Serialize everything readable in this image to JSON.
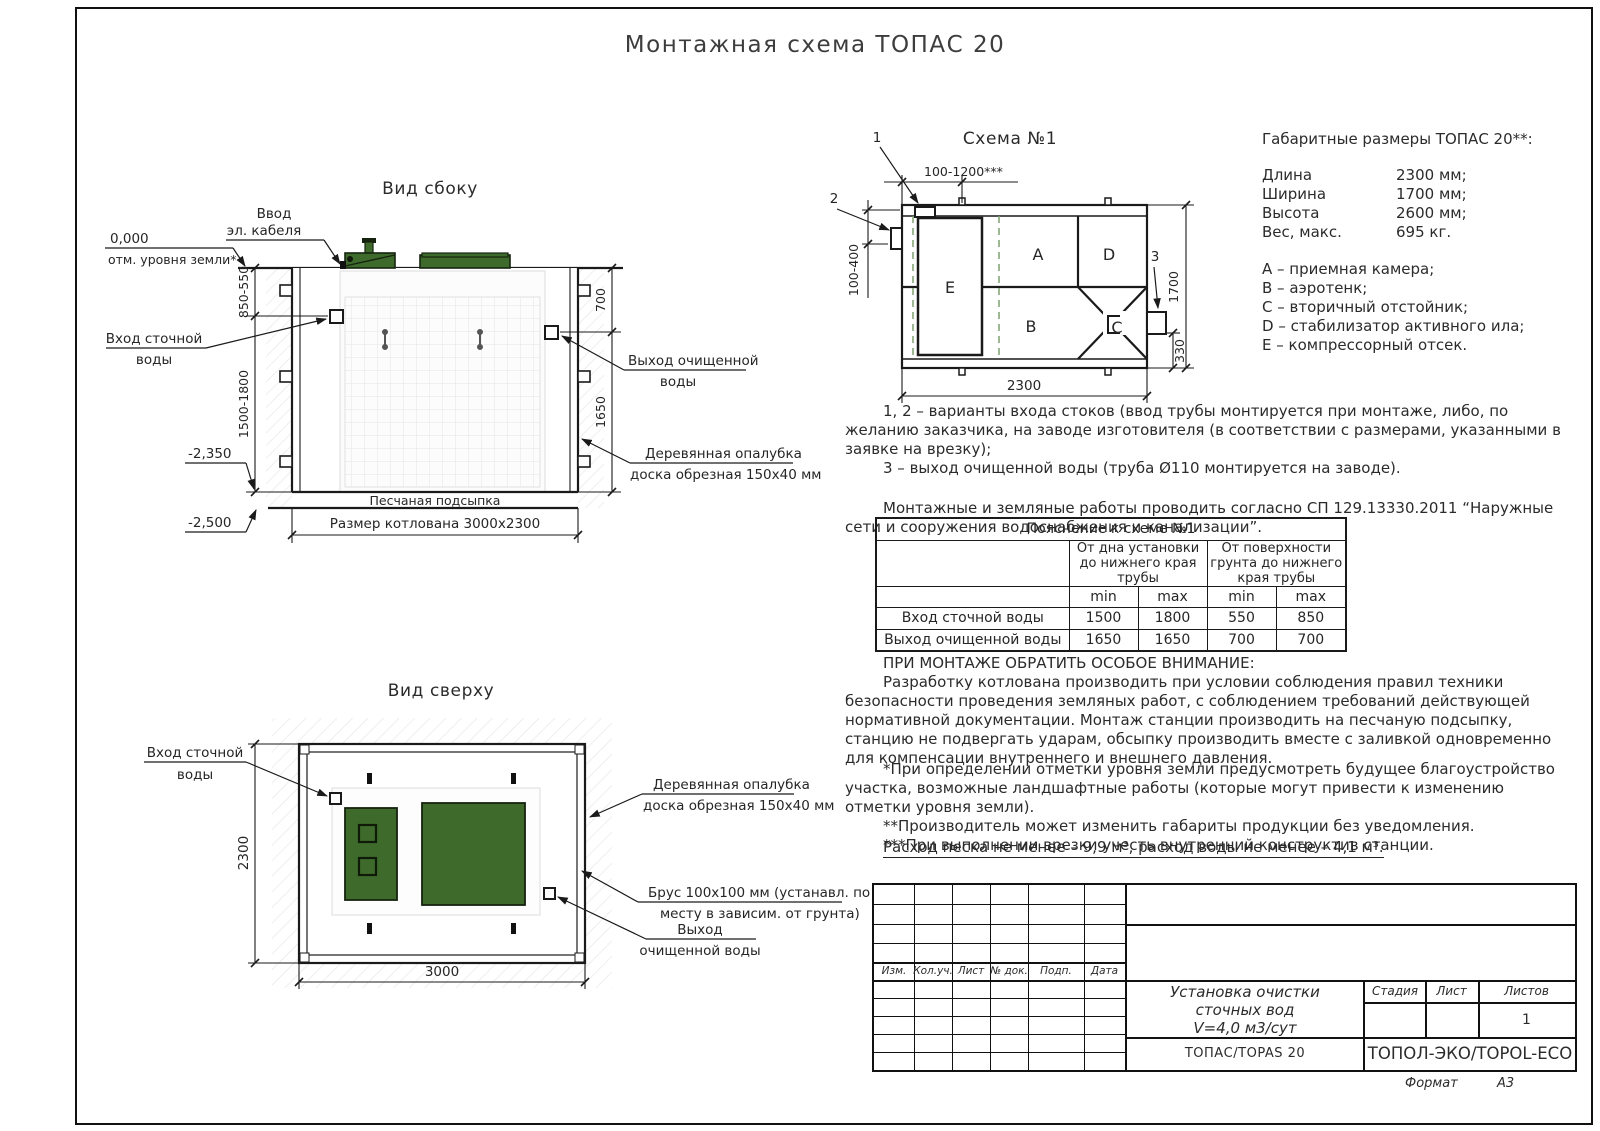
{
  "page": {
    "title": "Монтажная схема ТОПАС 20",
    "format_label": "Формат",
    "format_value": "А3"
  },
  "side": {
    "title": "Вид сбоку",
    "cable": [
      "Ввод",
      "эл. кабеля"
    ],
    "zero_mark": "0,000",
    "zero_label": "отм. уровня земли*",
    "inlet": [
      "Вход сточной",
      "воды"
    ],
    "outlet": [
      "Выход очищенной",
      "воды"
    ],
    "formwork": [
      "Деревянная опалубка",
      "доска обрезная 150х40 мм"
    ],
    "sand": "Песчаная подсыпка",
    "pit": "Размер котлована 3000х2300",
    "level_bottom": "-2,350",
    "level_sand": "-2,500",
    "dim_top_left": "850-550",
    "dim_bottom_left": "1500-1800",
    "dim_top_right": "700",
    "dim_bottom_right": "1650"
  },
  "top": {
    "title": "Вид сверху",
    "inlet": [
      "Вход сточной",
      "воды"
    ],
    "formwork": [
      "Деревянная опалубка",
      "доска обрезная 150х40 мм"
    ],
    "beam": [
      "Брус 100х100 мм (устанавл. по",
      "месту в зависим. от грунта)"
    ],
    "outlet": [
      "Выход",
      "очищенной воды"
    ],
    "dim_width": "3000",
    "dim_height": "2300"
  },
  "schema": {
    "title": "Схема №1",
    "markers": [
      "1",
      "2",
      "3"
    ],
    "compartments": {
      "a": "A",
      "b": "B",
      "c": "C",
      "d": "D",
      "e": "E"
    },
    "dim_top": "100-1200***",
    "dim_left": "100-400",
    "dim_right": "1700",
    "dim_bottom": "2300",
    "dim_outlet": "330"
  },
  "overall": {
    "title": "Габаритные размеры ТОПАС 20**:",
    "rows": [
      {
        "label": "Длина",
        "value": "2300 мм;"
      },
      {
        "label": "Ширина",
        "value": "1700 мм;"
      },
      {
        "label": "Высота",
        "value": "2600 мм;"
      },
      {
        "label": "Вес, макс.",
        "value": "695 кг."
      }
    ],
    "legend": [
      "А – приемная камера;",
      "В – аэротенк;",
      "С – вторичный отстойник;",
      "D – стабилизатор активного ила;",
      "Е – компрессорный отсек."
    ]
  },
  "notes": {
    "variants_1": "1, 2 – варианты входа  стоков (ввод трубы монтируется при монтаже, либо, по желанию заказчика, на заводе изготовителя (в соответствии с размерами, указанными в заявке на врезку);",
    "variants_2": "3 – выход очищенной воды (труба Ø110 монтируется на заводе).",
    "mounting": "Монтажные и земляные работы проводить согласно СП 129.13330.2011 “Наружные сети и сооружения водоснабжения и канализации”."
  },
  "table": {
    "title": "Пояснение к схеме №1",
    "group1": "От дна установки до нижнего края трубы",
    "group2": "От поверхности грунта до нижнего края трубы",
    "min": "min",
    "max": "max",
    "rows": [
      [
        "Вход сточной воды",
        "1500",
        "1800",
        "550",
        "850"
      ],
      [
        "Выход очищенной воды",
        "1650",
        "1650",
        "700",
        "700"
      ]
    ]
  },
  "attention": {
    "title": "ПРИ МОНТАЖЕ ОБРАТИТЬ ОСОБОЕ ВНИМАНИЕ:",
    "body": "Разработку котлована производить при условии соблюдения правил техники безопасности проведения земляных работ, с соблюдением требований действующей нормативной документации. Монтаж станции производить на песчаную подсыпку, станцию не подвергать ударам, обсыпку производить вместе с заливкой одновременно для компенсации внутреннего и внешнего давления."
  },
  "footnotes": [
    "*При определении отметки уровня земли предусмотреть будущее благоустройство участка, возможные ландшафтные работы (которые могут привести к изменению отметки уровня земли).",
    "**Производитель может изменить габариты продукции без уведомления.",
    "***При выполнении врезки учесть внутренний конструктив станции."
  ],
  "consumption": "Расход песка не менее – 9,9 м³, расход воды не менее – 4,1 м³.",
  "stamp": {
    "headers": [
      "Изм.",
      "Кол.уч.",
      "Лист",
      "№ док.",
      "Подп.",
      "Дата"
    ],
    "doc_title": [
      "Установка очистки",
      "сточных вод",
      "V=4,0 м3/сут"
    ],
    "stage": "Стадия",
    "sheet": "Лист",
    "sheets": "Листов",
    "sheets_value": "1",
    "product": "ТОПАС/TOPAS 20",
    "company": "ТОПОЛ-ЭКО/TOPOL-ECO"
  },
  "colors": {
    "green": "#3e6b2c",
    "green_dark": "#16230f",
    "line": "#1a1a1a"
  }
}
